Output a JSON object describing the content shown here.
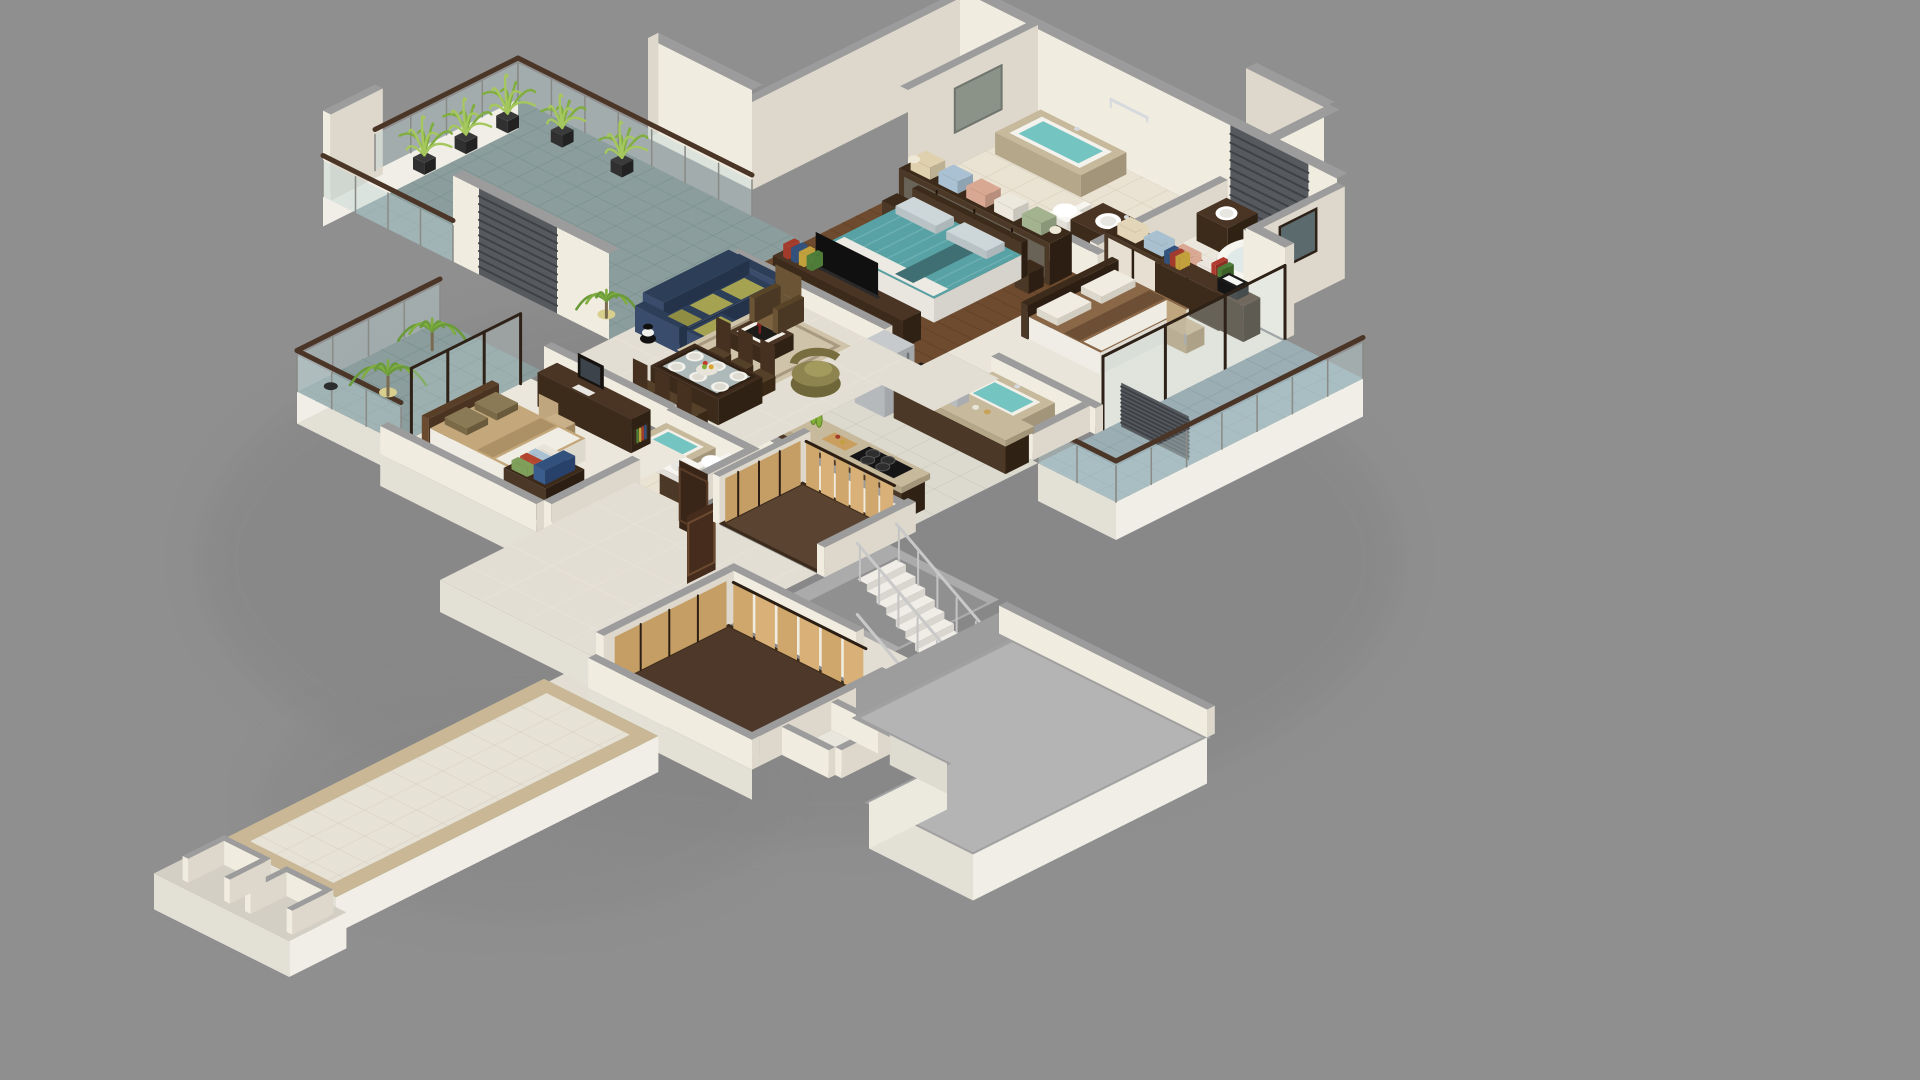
{
  "meta": {
    "title": "3D isometric apartment floor plan render",
    "view": "isometric cutaway, single storey, gray studio background",
    "visible_text": ""
  },
  "palette": {
    "background": "#8f8f8f",
    "wallLit": "#f1ece0",
    "wallShade": "#ddd8cb",
    "cap": "#9c9c9c",
    "floorMarble": "#e3ded3",
    "marbleLine": "#f0ece2",
    "floorBeige": "#eae2d2",
    "beigeLine": "#d8d0bd",
    "floorCream": "#ece7dc",
    "wood": "#6e4b2f",
    "woodLine": "#5a3c24",
    "slate": "#8b9d9d",
    "slateLine": "#798c8c",
    "slateBlue": "#9aaeb4",
    "slateBlueLine": "#899da5",
    "kitchenFloor": "#dcd9cf",
    "kitchenLine": "#c9c6bc",
    "carpet": "#5a4331",
    "carpet2": "#4e382a",
    "furnDark": "#3c2b1b",
    "furnMid": "#5a3f28",
    "woodTop": "#4a3424",
    "woodLight": "#d8b078",
    "woodLightShade": "#c59e66",
    "granite": "#c7b99c",
    "graniteSide": "#b5a88a",
    "teal": "#58a2a5",
    "tealLight": "#79b7ba",
    "water": "#74c4c1",
    "navy": "#2d3e59",
    "navyLight": "#3a4c6b",
    "navyDark": "#24324a",
    "olive": "#a5a251",
    "oliveDark": "#8f8c44",
    "tanBed": "#c4a87c",
    "brownBed": "#8a6747",
    "rug": "#cfc3aa",
    "rugBorder": "#a79a80",
    "white": "#f7f5f0",
    "whiteShade": "#e2dfd8",
    "chrome": "#d6dadd",
    "fridge": "#b5b9bb",
    "fridgeSide": "#a3a7a9",
    "green": "#7fae3e",
    "greenLight": "#a5c75e",
    "louver": "#565a5e",
    "louverLine": "#3e4246",
    "rail": "#4a3527",
    "stepTop": "#efede6",
    "stepFace": "#d9d6cf",
    "stairRail": "#c9c9c9",
    "slab": "#b4b4b4",
    "fascia": "#f0eee6",
    "fasciaShade": "#e3e0d6",
    "doorDark": "#3a2519",
    "bookRed": "#b03a2e",
    "bookGreen": "#4e7d3a",
    "linens": [
      "#dfd0ae",
      "#a9c1d2",
      "#d9a893",
      "#ece8de",
      "#a3b28f"
    ]
  },
  "rooms": [
    {
      "name": "terrace",
      "label": "Tiled terrace",
      "floor": "slate tiles",
      "furniture": [
        "glass railing with wood handrail",
        "potted plants",
        "palm in pot"
      ]
    },
    {
      "name": "master-bathroom",
      "label": "Master bathroom",
      "floor": "beige tile",
      "furniture": [
        "built-in tub with water",
        "toilet",
        "vanity sink",
        "mirror",
        "towel rail",
        "window"
      ]
    },
    {
      "name": "guest-bathroom",
      "label": "Second bathroom",
      "floor": "cream tile",
      "furniture": [
        "oval bathtub",
        "round basin counter",
        "toilet",
        "mirror"
      ]
    },
    {
      "name": "master-bedroom",
      "label": "Master bedroom",
      "floor": "dark wood planks",
      "furniture": [
        "double bed teal cover",
        "headboard",
        "linen wardrobe with folded towels",
        "side tables with lamps",
        "tv console with books"
      ]
    },
    {
      "name": "bedroom-right",
      "label": "Right bedroom",
      "floor": "cream",
      "furniture": [
        "double bed brown cover",
        "desk with printer and books",
        "office chair",
        "linen wardrobe",
        "sliding glass doors"
      ]
    },
    {
      "name": "balcony-right",
      "label": "Right balcony",
      "floor": "blue slate tiles",
      "furniture": [
        "glass railing with wood handrail",
        "louver unit"
      ]
    },
    {
      "name": "jacuzzi-bath-right",
      "label": "Jacuzzi room",
      "floor": "beige tile",
      "furniture": [
        "sunken jacuzzi tub"
      ]
    },
    {
      "name": "kitchen",
      "label": "Kitchen",
      "floor": "gray tile",
      "furniture": [
        "fridge",
        "wall counter with coffee machine and toaster",
        "island with cooktop",
        "dish rack with green plates",
        "cutting board"
      ]
    },
    {
      "name": "living-room",
      "label": "Living room",
      "floor": "cream marble",
      "furniture": [
        "navy corner sofa with olive cushions",
        "brown armchair",
        "olive barrel chair",
        "coffee table with tray",
        "area rug",
        "striped vase"
      ]
    },
    {
      "name": "dining-area",
      "label": "Dining area",
      "floor": "cream marble",
      "furniture": [
        "dark dining table",
        "six chairs",
        "place settings",
        "fruit bowl"
      ]
    },
    {
      "name": "balcony-left",
      "label": "Left balcony",
      "floor": "slate tiles",
      "furniture": [
        "glass railing with wood handrail",
        "palm plants"
      ]
    },
    {
      "name": "bedroom-left",
      "label": "Left bedroom",
      "floor": "cream",
      "furniture": [
        "double bed tan cover",
        "desk with monitor and keyboard",
        "office chair",
        "wardrobe with folded linens and books"
      ]
    },
    {
      "name": "ensuite-left",
      "label": "Left ensuite",
      "floor": "beige tile",
      "furniture": [
        "jacuzzi tub",
        "toilet",
        "vanity sink"
      ]
    },
    {
      "name": "hallway",
      "label": "Hallway",
      "floor": "cream marble",
      "furniture": [
        "open wooden doors"
      ]
    },
    {
      "name": "walk-in-closet-upper",
      "label": "Walk-in closet",
      "floor": "brown carpet",
      "furniture": [
        "light wood wardrobe doors"
      ]
    },
    {
      "name": "staircase",
      "label": "Staircase",
      "floor": "gray concrete",
      "furniture": [
        "white open stairs",
        "steel rod railing"
      ]
    },
    {
      "name": "walk-in-closet-lower",
      "label": "Dressing room",
      "floor": "brown carpet",
      "furniture": [
        "light wood wardrobe doors"
      ]
    },
    {
      "name": "entrance-walkway",
      "label": "Entrance walkway",
      "floor": "beige tile with border",
      "furniture": []
    },
    {
      "name": "lower-terrace-slab",
      "label": "Lower level slab",
      "floor": "gray concrete",
      "furniture": [
        "service cells"
      ]
    },
    {
      "name": "exterior-walls",
      "label": "Exterior walls",
      "floor": "",
      "furniture": [
        "louvered panels",
        "service shaft"
      ]
    }
  ]
}
